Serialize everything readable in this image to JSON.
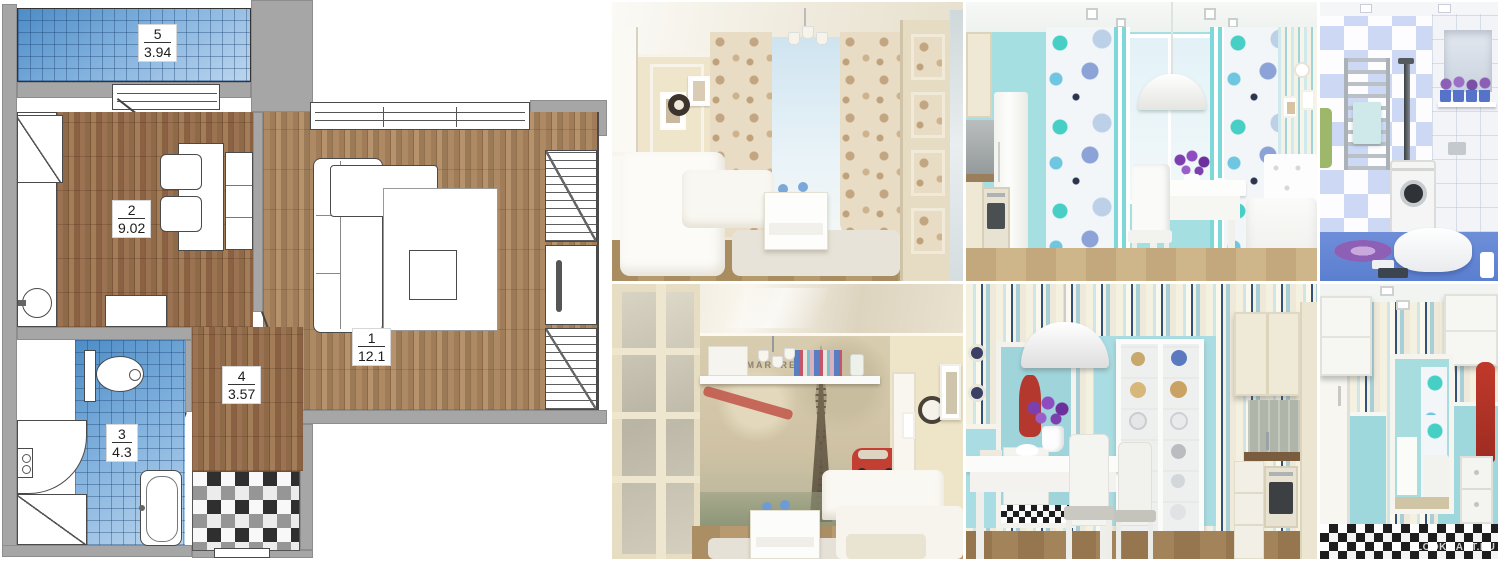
{
  "floor_plan": {
    "rooms": [
      {
        "name": "living-room",
        "number": "1",
        "area": "12.1"
      },
      {
        "name": "kitchen",
        "number": "2",
        "area": "9.02"
      },
      {
        "name": "bathroom",
        "number": "3",
        "area": "4.3"
      },
      {
        "name": "hallway",
        "number": "4",
        "area": "3.57"
      },
      {
        "name": "balcony",
        "number": "5",
        "area": "3.94"
      }
    ],
    "colors": {
      "wall_gray": "#a6a6a6",
      "tile_blue_dark": "#4c8cc6",
      "tile_blue_light": "#bcd6ee",
      "wood_dark": "#7c573a",
      "wood_light": "#b6936c"
    }
  },
  "mural": {
    "text": "MONTMARTRE"
  },
  "watermark": "LOOKMART.RU",
  "photos": [
    {
      "name": "living-room-classic-cream"
    },
    {
      "name": "kitchen-dining-turquoise"
    },
    {
      "name": "bathroom-blue-tile"
    },
    {
      "name": "living-room-paris-mural"
    },
    {
      "name": "dining-room-striped-wallpaper"
    },
    {
      "name": "hallway-checkered-floor"
    }
  ],
  "photo_colors": {
    "cream_wall": "#efe5cb",
    "turquoise_wall": "#a5dfe2",
    "bath_floor_blue": "#5b7fd0",
    "accent_red": "#b5382e",
    "flower_purple": "#7e3fae"
  }
}
